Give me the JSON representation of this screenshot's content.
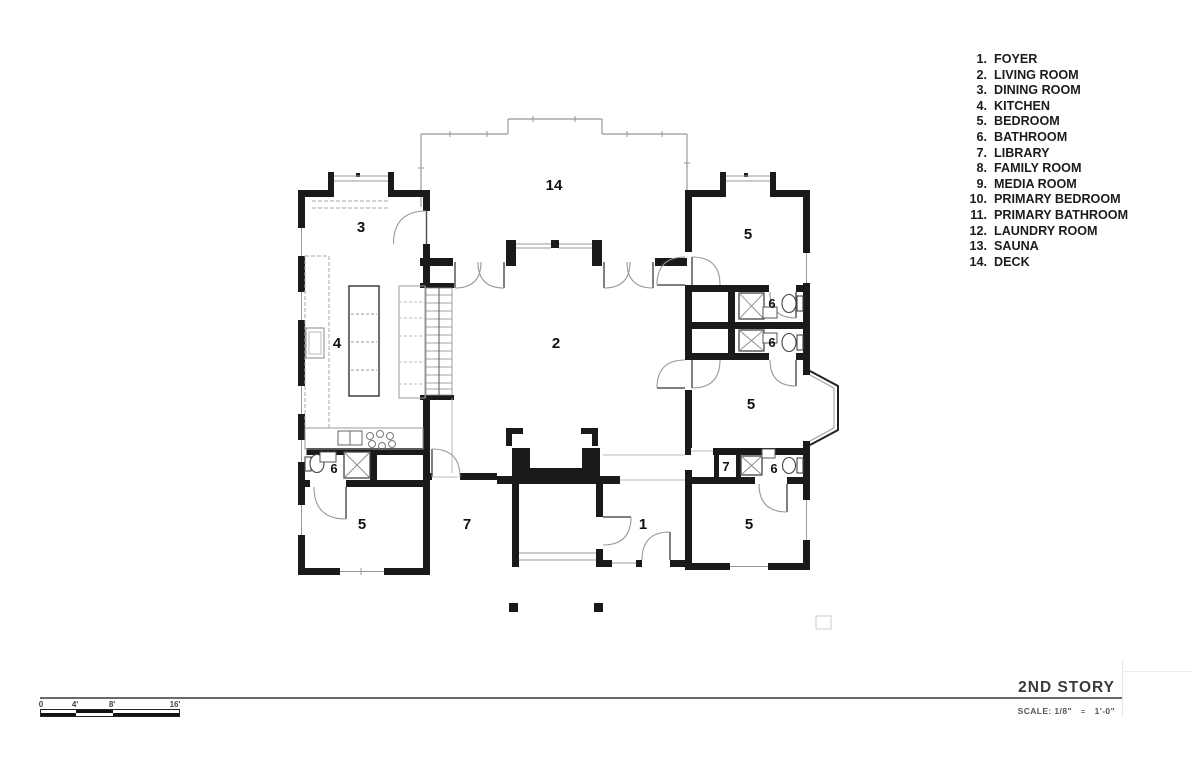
{
  "legend": {
    "items": [
      {
        "num": "1.",
        "label": "FOYER"
      },
      {
        "num": "2.",
        "label": "LIVING ROOM"
      },
      {
        "num": "3.",
        "label": "DINING ROOM"
      },
      {
        "num": "4.",
        "label": "KITCHEN"
      },
      {
        "num": "5.",
        "label": "BEDROOM"
      },
      {
        "num": "6.",
        "label": "BATHROOM"
      },
      {
        "num": "7.",
        "label": "LIBRARY"
      },
      {
        "num": "8.",
        "label": "FAMILY ROOM"
      },
      {
        "num": "9.",
        "label": "MEDIA ROOM"
      },
      {
        "num": "10.",
        "label": "PRIMARY BEDROOM"
      },
      {
        "num": "11.",
        "label": "PRIMARY BATHROOM"
      },
      {
        "num": "12.",
        "label": "LAUNDRY ROOM"
      },
      {
        "num": "13.",
        "label": "SAUNA"
      },
      {
        "num": "14.",
        "label": "DECK"
      }
    ]
  },
  "plan": {
    "rooms": [
      {
        "label": "14"
      },
      {
        "label": "3"
      },
      {
        "label": "5"
      },
      {
        "label": "4"
      },
      {
        "label": "2"
      },
      {
        "label": "6"
      },
      {
        "label": "6"
      },
      {
        "label": "5"
      },
      {
        "label": "6"
      },
      {
        "label": "7"
      },
      {
        "label": "6"
      },
      {
        "label": "5"
      },
      {
        "label": "7"
      },
      {
        "label": "1"
      },
      {
        "label": "5"
      }
    ]
  },
  "title_block": {
    "title": "2ND STORY",
    "scale_prefix": "SCALE: 1/8\"",
    "scale_eq": "=",
    "scale_suffix": "1'-0\""
  },
  "scale_bar": {
    "ticks": [
      "0",
      "4'",
      "8'",
      "16'"
    ]
  },
  "colors": {
    "wall_ink": "#1a1a1a",
    "thin_line": "#999999"
  }
}
